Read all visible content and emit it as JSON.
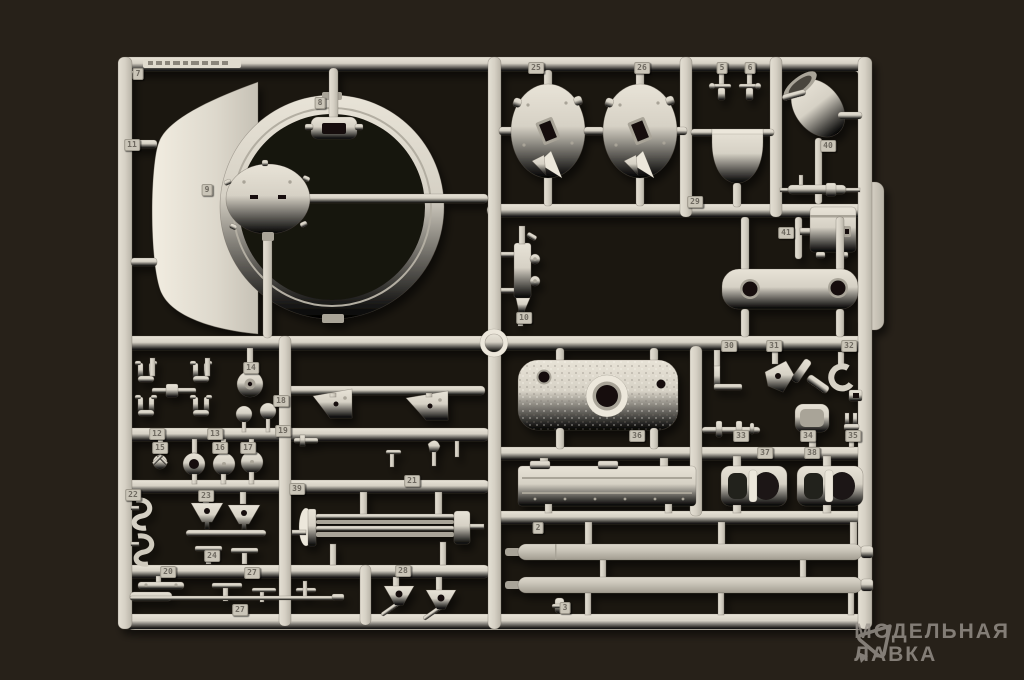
{
  "watermark": {
    "line1": "МОДЕЛЬНАЯ",
    "line2": "ЛАВКА",
    "logo": "cursor-triangle-logo"
  },
  "colors": {
    "background_top": "#241e19",
    "background_bottom": "#3b342c",
    "sprue_plastic": "#d6d1c5",
    "plastic_highlight": "#ece7db",
    "plastic_shadow": "#a9a498",
    "interior_shadow": "#15110e",
    "watermark_gray": "#9b958e",
    "tag_face": "#cac5b8",
    "tag_digit": "#6e6960"
  },
  "sprue": {
    "part_tags": [
      {
        "x": 138,
        "y": 74,
        "label": "7"
      },
      {
        "x": 132,
        "y": 145,
        "label": "11"
      },
      {
        "x": 320,
        "y": 103,
        "label": "8"
      },
      {
        "x": 207,
        "y": 190,
        "label": "9"
      },
      {
        "x": 536,
        "y": 68,
        "label": "25"
      },
      {
        "x": 642,
        "y": 68,
        "label": "26"
      },
      {
        "x": 722,
        "y": 68,
        "label": "5"
      },
      {
        "x": 750,
        "y": 68,
        "label": "6"
      },
      {
        "x": 828,
        "y": 146,
        "label": "40"
      },
      {
        "x": 695,
        "y": 202,
        "label": "29"
      },
      {
        "x": 786,
        "y": 233,
        "label": "41"
      },
      {
        "x": 524,
        "y": 318,
        "label": "10"
      },
      {
        "x": 251,
        "y": 368,
        "label": "14"
      },
      {
        "x": 157,
        "y": 434,
        "label": "12"
      },
      {
        "x": 215,
        "y": 434,
        "label": "13"
      },
      {
        "x": 160,
        "y": 448,
        "label": "15"
      },
      {
        "x": 220,
        "y": 448,
        "label": "16"
      },
      {
        "x": 248,
        "y": 448,
        "label": "17"
      },
      {
        "x": 281,
        "y": 401,
        "label": "18"
      },
      {
        "x": 283,
        "y": 431,
        "label": "19"
      },
      {
        "x": 168,
        "y": 572,
        "label": "20"
      },
      {
        "x": 412,
        "y": 481,
        "label": "21"
      },
      {
        "x": 133,
        "y": 495,
        "label": "22"
      },
      {
        "x": 206,
        "y": 496,
        "label": "23"
      },
      {
        "x": 212,
        "y": 556,
        "label": "24"
      },
      {
        "x": 297,
        "y": 489,
        "label": "39"
      },
      {
        "x": 252,
        "y": 573,
        "label": "27"
      },
      {
        "x": 240,
        "y": 610,
        "label": "27"
      },
      {
        "x": 403,
        "y": 571,
        "label": "28"
      },
      {
        "x": 729,
        "y": 346,
        "label": "30"
      },
      {
        "x": 774,
        "y": 346,
        "label": "31"
      },
      {
        "x": 849,
        "y": 346,
        "label": "32"
      },
      {
        "x": 741,
        "y": 436,
        "label": "33"
      },
      {
        "x": 808,
        "y": 436,
        "label": "34"
      },
      {
        "x": 853,
        "y": 436,
        "label": "35"
      },
      {
        "x": 637,
        "y": 436,
        "label": "36"
      },
      {
        "x": 765,
        "y": 453,
        "label": "37"
      },
      {
        "x": 812,
        "y": 453,
        "label": "38"
      },
      {
        "x": 538,
        "y": 528,
        "label": "2"
      },
      {
        "x": 565,
        "y": 608,
        "label": "3"
      }
    ]
  }
}
